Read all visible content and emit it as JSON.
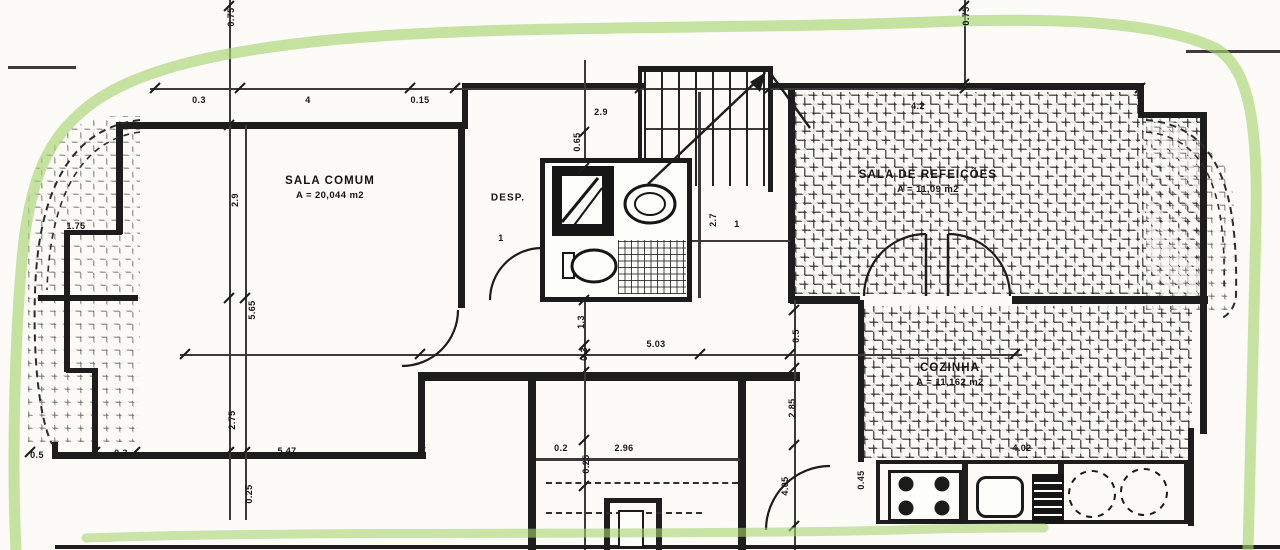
{
  "plan_title": "apartment-floor-plan",
  "colors": {
    "ink": "#1d1d1d",
    "paper": "#fcfbf7",
    "highlighter": "#a8d472"
  },
  "rooms": {
    "sala_comum": {
      "name": "SALA COMUM",
      "area": "A = 20,044 m2"
    },
    "despensa": {
      "name": "DESP."
    },
    "sala_refeicoes": {
      "name": "SALA DE REFEIÇÕES",
      "area": "A = 11,09 m2"
    },
    "cozinha": {
      "name": "COZINHA",
      "area": "A = 11,162 m2"
    }
  },
  "dimensions": [
    {
      "text": "0.75",
      "x": 231,
      "y": 17,
      "rot": true
    },
    {
      "text": "0.3",
      "x": 199,
      "y": 100,
      "rot": false
    },
    {
      "text": "4",
      "x": 308,
      "y": 100,
      "rot": false
    },
    {
      "text": "0.15",
      "x": 420,
      "y": 100,
      "rot": false
    },
    {
      "text": "2.9",
      "x": 601,
      "y": 112,
      "rot": false
    },
    {
      "text": "4.2",
      "x": 918,
      "y": 106,
      "rot": false
    },
    {
      "text": "0.75",
      "x": 966,
      "y": 16,
      "rot": true
    },
    {
      "text": "1.75",
      "x": 76,
      "y": 226,
      "rot": false
    },
    {
      "text": "2.9",
      "x": 235,
      "y": 200,
      "rot": true
    },
    {
      "text": "5.65",
      "x": 252,
      "y": 310,
      "rot": true
    },
    {
      "text": "2.75",
      "x": 232,
      "y": 420,
      "rot": true
    },
    {
      "text": "0.25",
      "x": 249,
      "y": 494,
      "rot": true
    },
    {
      "text": "0.5",
      "x": 37,
      "y": 455,
      "rot": false
    },
    {
      "text": "0.3",
      "x": 121,
      "y": 453,
      "rot": false
    },
    {
      "text": "5.47",
      "x": 287,
      "y": 451,
      "rot": false
    },
    {
      "text": "0.65",
      "x": 577,
      "y": 142,
      "rot": true
    },
    {
      "text": "1",
      "x": 501,
      "y": 238,
      "rot": false
    },
    {
      "text": "1.3",
      "x": 581,
      "y": 322,
      "rot": true
    },
    {
      "text": "0.3",
      "x": 584,
      "y": 354,
      "rot": true
    },
    {
      "text": "5.03",
      "x": 656,
      "y": 344,
      "rot": false
    },
    {
      "text": "2.7",
      "x": 713,
      "y": 220,
      "rot": true
    },
    {
      "text": "1",
      "x": 737,
      "y": 224,
      "rot": false
    },
    {
      "text": "0.2",
      "x": 561,
      "y": 448,
      "rot": false
    },
    {
      "text": "2.96",
      "x": 624,
      "y": 448,
      "rot": false
    },
    {
      "text": "0.25",
      "x": 586,
      "y": 464,
      "rot": true
    },
    {
      "text": "0.5",
      "x": 796,
      "y": 336,
      "rot": true
    },
    {
      "text": "2.85",
      "x": 792,
      "y": 408,
      "rot": true
    },
    {
      "text": "4.05",
      "x": 785,
      "y": 486,
      "rot": true
    },
    {
      "text": "0.45",
      "x": 861,
      "y": 480,
      "rot": true
    },
    {
      "text": "4.02",
      "x": 1022,
      "y": 448,
      "rot": false
    }
  ]
}
